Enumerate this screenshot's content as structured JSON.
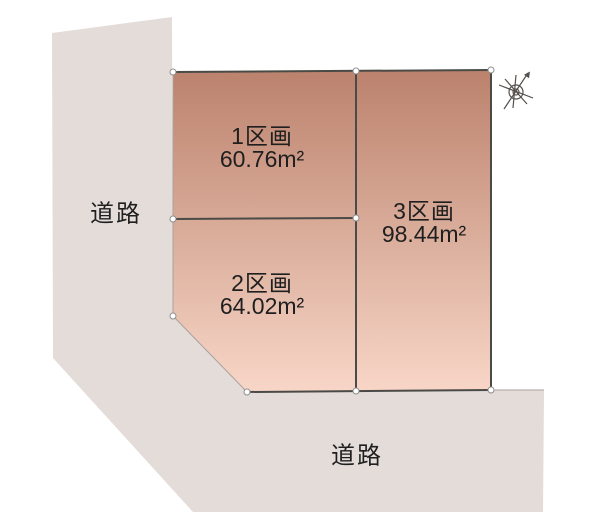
{
  "plan": {
    "lots": [
      {
        "name": "1区画",
        "area": "60.76m²"
      },
      {
        "name": "2区画",
        "area": "64.02m²"
      },
      {
        "name": "3区画",
        "area": "98.44m²"
      }
    ],
    "road_left": {
      "label": "道路"
    },
    "road_bottom": {
      "label": "道路"
    },
    "compass": {
      "icon": "compass-north-arrow"
    },
    "colors": {
      "background": "#ffffff",
      "road": "#e3dcd9",
      "lot_gradient_top": "#bb826d",
      "lot_gradient_bottom": "#f8d6c7",
      "border_dark": "#4a4a47",
      "border_light": "#a9a29e",
      "node_fill": "#ffffff",
      "node_stroke": "#8f8f8f",
      "compass_stroke": "#55504d",
      "text": "#1f1f1f"
    }
  }
}
